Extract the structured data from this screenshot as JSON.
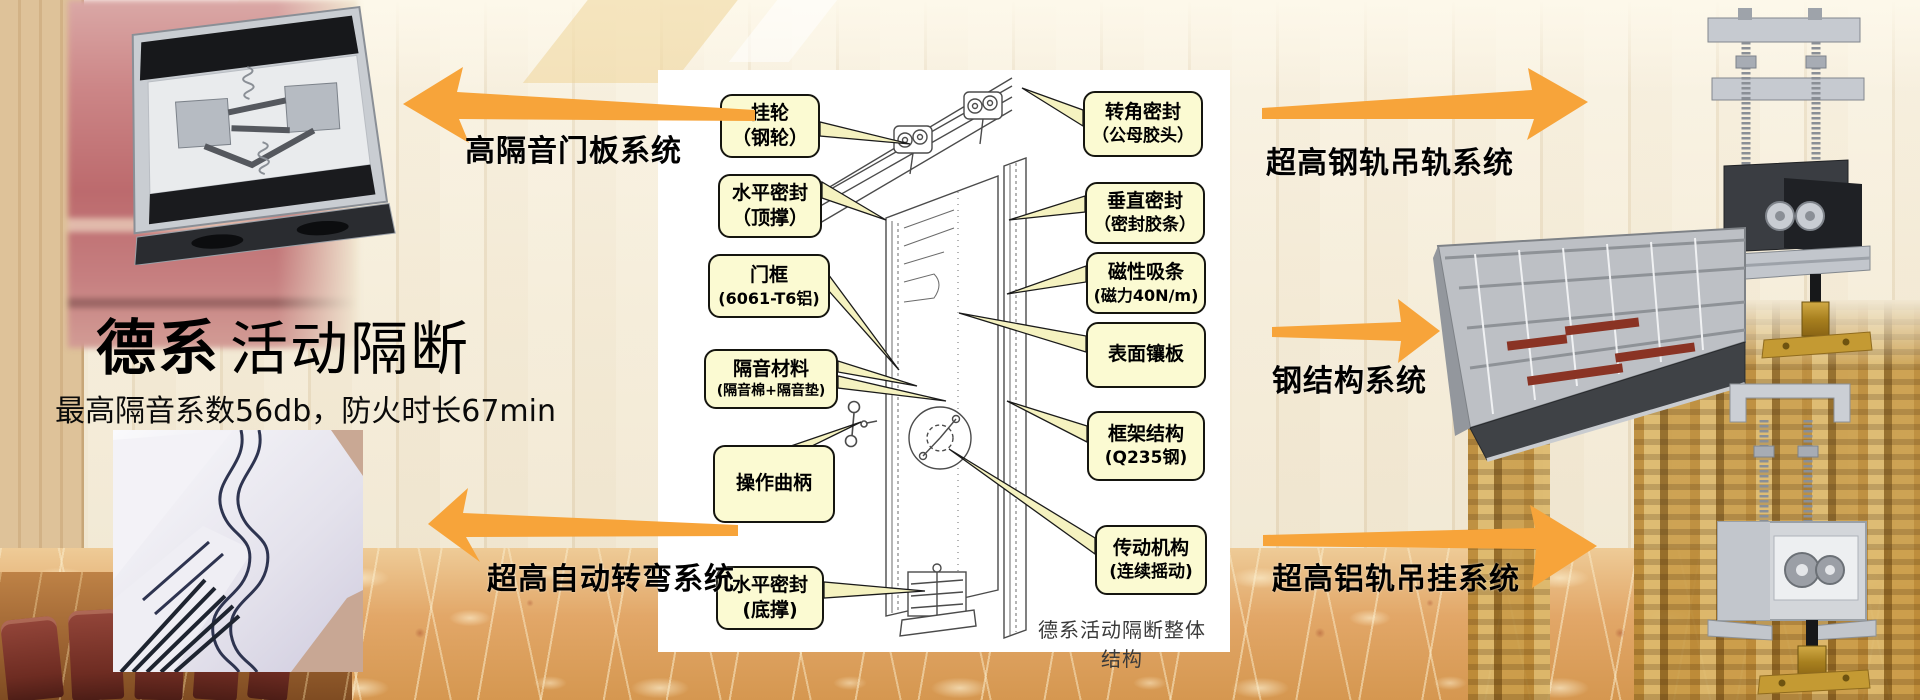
{
  "header": {
    "title_strong": "德系",
    "title_light": "活动隔断",
    "subtitle": "最高隔音系数56db，防火时长67min"
  },
  "systems": [
    {
      "label": "高隔音门板系统",
      "direction": "left"
    },
    {
      "label": "超高钢轨吊轨系统",
      "direction": "right"
    },
    {
      "label": "钢结构系统",
      "direction": "right"
    },
    {
      "label": "超高自动转弯系统",
      "direction": "left"
    },
    {
      "label": "超高铝轨吊挂系统",
      "direction": "right"
    }
  ],
  "diagram": {
    "caption": "德系活动隔断整体结构",
    "left_labels": [
      {
        "lines": [
          "挂轮",
          "（钢轮）"
        ]
      },
      {
        "lines": [
          "水平密封",
          "（顶撑）"
        ]
      },
      {
        "lines": [
          "门框",
          "(6061-T6铝)"
        ]
      },
      {
        "lines": [
          "隔音材料",
          "(隔音棉+隔音垫)"
        ]
      },
      {
        "lines": [
          "操作曲柄"
        ]
      },
      {
        "lines": [
          "水平密封",
          "(底撑)"
        ]
      }
    ],
    "right_labels": [
      {
        "lines": [
          "转角密封",
          "（公母胶头）"
        ]
      },
      {
        "lines": [
          "垂直密封",
          "（密封胶条）"
        ]
      },
      {
        "lines": [
          "磁性吸条",
          "(磁力40N/m)"
        ]
      },
      {
        "lines": [
          "表面镶板"
        ]
      },
      {
        "lines": [
          "框架结构",
          "(Q235钢)"
        ]
      },
      {
        "lines": [
          "传动机构",
          "(连续摇动)"
        ]
      }
    ]
  },
  "colors": {
    "arrow_orange": "#F7A43A",
    "callout_bg": "#FBFAD2",
    "callout_border": "#15150F",
    "background_cream": "#F1E7D1"
  }
}
